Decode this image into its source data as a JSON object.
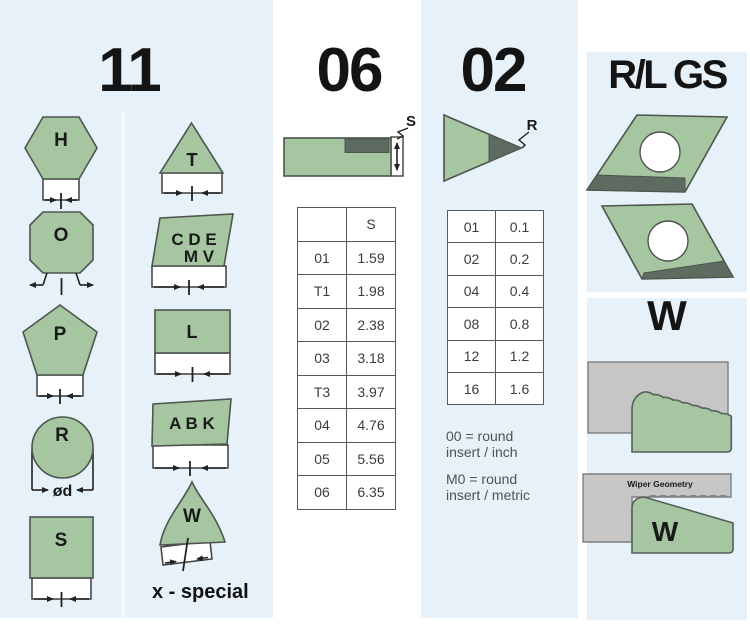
{
  "colors": {
    "panel_blue": "#e6f1f9",
    "insert_green": "#a6c6a2",
    "insert_dark": "#5d6b60",
    "block_gray": "#c5c6c5"
  },
  "col11": {
    "title": "11",
    "labels": {
      "h": "H",
      "o": "O",
      "p": "P",
      "r": "R",
      "s": "S",
      "t": "T",
      "cde": "C D E",
      "mv": "M V",
      "l": "L",
      "abk": "A B K",
      "w": "W"
    },
    "dim_diameter": "ød",
    "special": "x - special"
  },
  "col06": {
    "title": "06",
    "dim_thickness": "S",
    "table": {
      "header": [
        "",
        "S"
      ],
      "rows": [
        [
          "01",
          "1.59"
        ],
        [
          "T1",
          "1.98"
        ],
        [
          "02",
          "2.38"
        ],
        [
          "03",
          "3.18"
        ],
        [
          "T3",
          "3.97"
        ],
        [
          "04",
          "4.76"
        ],
        [
          "05",
          "5.56"
        ],
        [
          "06",
          "6.35"
        ]
      ]
    }
  },
  "col02": {
    "title": "02",
    "dim_radius": "R",
    "table": {
      "rows": [
        [
          "01",
          "0.1"
        ],
        [
          "02",
          "0.2"
        ],
        [
          "04",
          "0.4"
        ],
        [
          "08",
          "0.8"
        ],
        [
          "12",
          "1.2"
        ],
        [
          "16",
          "1.6"
        ]
      ]
    },
    "notes": [
      "00 = round\ninsert / inch",
      "M0 = round\ninsert / metric"
    ]
  },
  "rlgs": {
    "title": "R/L GS"
  },
  "wiper": {
    "title": "W",
    "block_label": "Wiper Geometry",
    "wedge_label": "W"
  }
}
